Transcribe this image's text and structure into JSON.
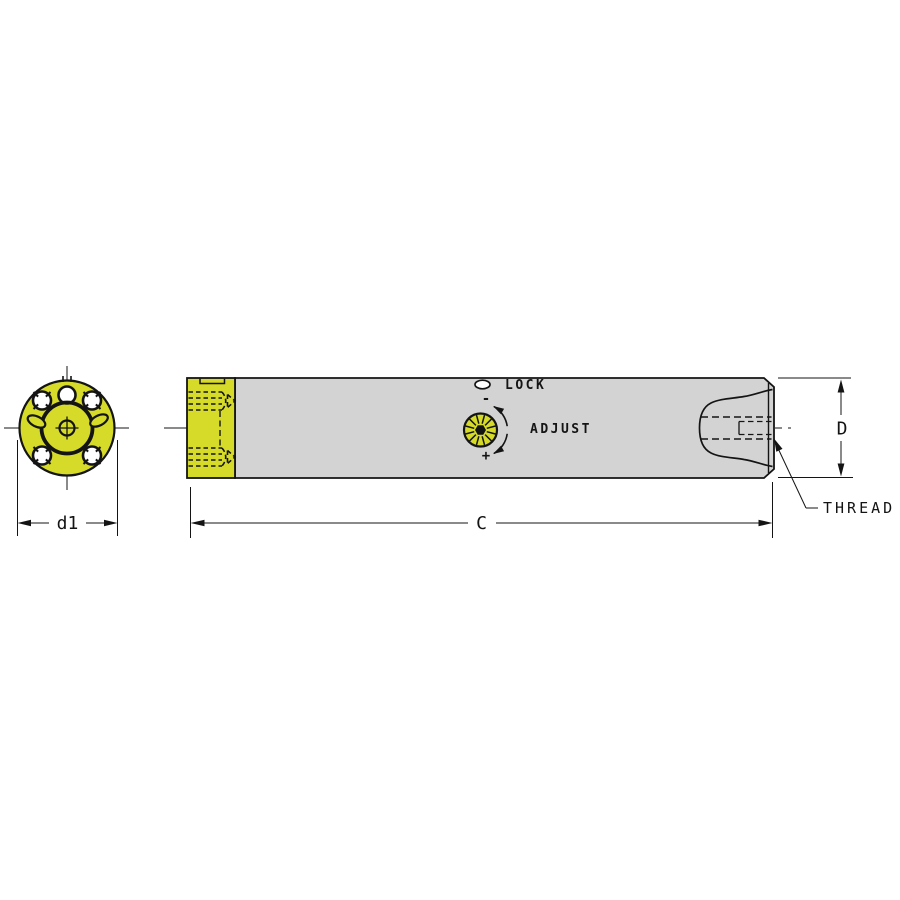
{
  "colors": {
    "yellow": "#d6da28",
    "gray": "#d3d3d3",
    "line": "#141414",
    "bg": "#ffffff"
  },
  "drawing": {
    "end_view": {
      "diameter_dimension_label": "d1"
    },
    "side_view": {
      "lock_label": "LOCK",
      "adjust_label": "ADJUST",
      "minus_label": "-",
      "plus_label": "+",
      "thread_label": "THREAD",
      "length_dimension_label": "C",
      "diameter_dimension_label": "D"
    }
  }
}
